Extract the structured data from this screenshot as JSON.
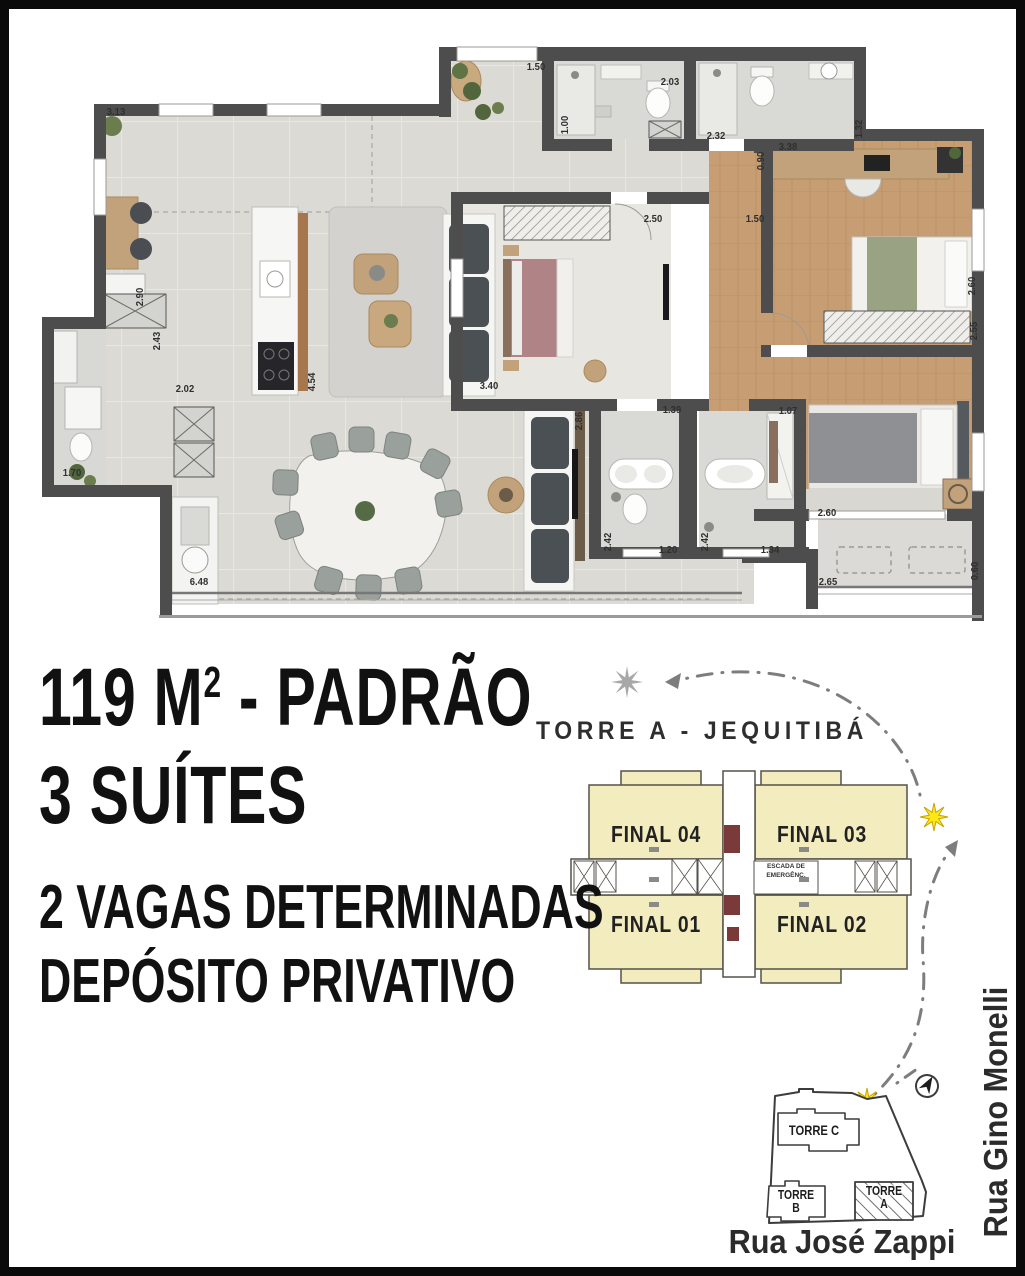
{
  "headline": {
    "line1_prefix": "119 M",
    "line1_sup": "2",
    "line1_suffix": "- PADRÃO",
    "line2": "3 SUÍTES",
    "line3": "2 VAGAS DETERMINADAS",
    "line4": "DEPÓSITO PRIVATIVO"
  },
  "key_plan": {
    "title": "TORRE A - JEQUITIBÁ",
    "stairs_label": "ESCADA DE EMERGÊNC.",
    "unit_fill": "#f3ecbf",
    "units": [
      {
        "label": "FINAL 04"
      },
      {
        "label": "FINAL 03"
      },
      {
        "label": "FINAL 01"
      },
      {
        "label": "FINAL 02"
      }
    ]
  },
  "site_plan": {
    "towers": [
      {
        "label": "TORRE C"
      },
      {
        "label": "TORRE B"
      },
      {
        "label": "TORRE A"
      }
    ],
    "streets": {
      "bottom": "Rua José Zappi",
      "right": "Rua Gino Monelli"
    },
    "highlight_color": "#ffe818"
  },
  "floor_plan": {
    "wall_color": "#4d4d4d",
    "dimensions": [
      {
        "t": "3.13",
        "x": 107,
        "y": 103,
        "r": 0
      },
      {
        "t": "1.50",
        "x": 527,
        "y": 58,
        "r": 0
      },
      {
        "t": "1.00",
        "x": 556,
        "y": 116,
        "r": -90
      },
      {
        "t": "2.03",
        "x": 661,
        "y": 73,
        "r": 0
      },
      {
        "t": "2.32",
        "x": 707,
        "y": 127,
        "r": 0
      },
      {
        "t": "1.32",
        "x": 850,
        "y": 120,
        "r": -90
      },
      {
        "t": "0.90",
        "x": 752,
        "y": 152,
        "r": -90
      },
      {
        "t": "3.38",
        "x": 779,
        "y": 138,
        "r": 0
      },
      {
        "t": "2.50",
        "x": 644,
        "y": 210,
        "r": 0
      },
      {
        "t": "1.50",
        "x": 746,
        "y": 210,
        "r": 0
      },
      {
        "t": "2.60",
        "x": 963,
        "y": 277,
        "r": -90
      },
      {
        "t": "2.55",
        "x": 965,
        "y": 322,
        "r": -90
      },
      {
        "t": "2.90",
        "x": 131,
        "y": 288,
        "r": -90
      },
      {
        "t": "2.43",
        "x": 148,
        "y": 332,
        "r": -90
      },
      {
        "t": "2.02",
        "x": 176,
        "y": 380,
        "r": 0
      },
      {
        "t": "4.54",
        "x": 303,
        "y": 373,
        "r": -90
      },
      {
        "t": "3.40",
        "x": 480,
        "y": 377,
        "r": 0
      },
      {
        "t": "2.86",
        "x": 570,
        "y": 412,
        "r": -90
      },
      {
        "t": "1.70",
        "x": 63,
        "y": 464,
        "r": 0
      },
      {
        "t": "6.48",
        "x": 190,
        "y": 573,
        "r": 0
      },
      {
        "t": "1.39",
        "x": 663,
        "y": 401,
        "r": 0
      },
      {
        "t": "1.07",
        "x": 779,
        "y": 402,
        "r": 0
      },
      {
        "t": "2.42",
        "x": 599,
        "y": 533,
        "r": -90
      },
      {
        "t": "1.20",
        "x": 659,
        "y": 541,
        "r": 0
      },
      {
        "t": "2.42",
        "x": 696,
        "y": 533,
        "r": -90
      },
      {
        "t": "1.34",
        "x": 761,
        "y": 541,
        "r": 0
      },
      {
        "t": "2.60",
        "x": 818,
        "y": 504,
        "r": 0
      },
      {
        "t": "2.65",
        "x": 819,
        "y": 573,
        "r": 0
      },
      {
        "t": "0.60",
        "x": 966,
        "y": 562,
        "r": -90
      }
    ]
  }
}
